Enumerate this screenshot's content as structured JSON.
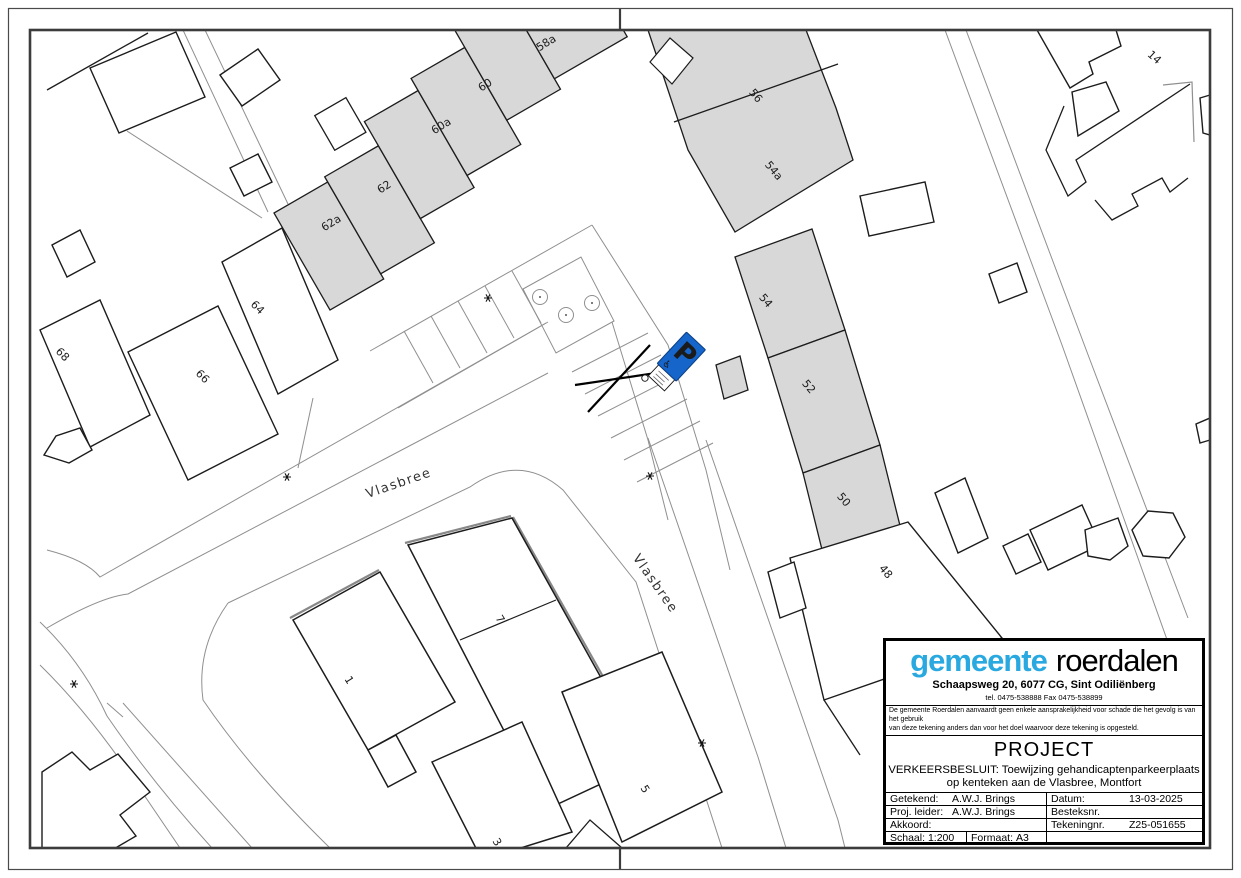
{
  "title_block": {
    "logo": {
      "word1": "gemeente",
      "word2": "roerdalen",
      "brand_color": "#29a9e0"
    },
    "address": "Schaapsweg 20, 6077 CG, Sint Odiliënberg",
    "phone": "tel. 0475-538888  Fax 0475-538899",
    "disclaimer_line1": "De gemeente Roerdalen aanvaardt geen enkele aansprakelijkheid voor schade die het gevolg is van het gebruik",
    "disclaimer_line2": "van deze tekening anders dan voor het doel waarvoor deze tekening is opgesteld.",
    "project_heading": "PROJECT",
    "project_line1": "VERKEERSBESLUIT: Toewijzing gehandicaptenparkeerplaats",
    "project_line2": "op kenteken aan de Vlasbree, Montfort",
    "fields": {
      "getekend_label": "Getekend:",
      "getekend_value": "A.W.J. Brings",
      "proj_leider_label": "Proj. leider:",
      "proj_leider_value": "A.W.J. Brings",
      "akkoord_label": "Akkoord:",
      "akkoord_value": "",
      "datum_label": "Datum:",
      "datum_value": "13-03-2025",
      "besteksnr_label": "Besteksnr.",
      "besteksnr_value": "",
      "tekeningnr_label": "Tekeningnr.",
      "tekeningnr_value": "Z25-051655",
      "schaal_label": "Schaal:",
      "schaal_value": "1:200",
      "formaat_label": "Formaat:",
      "formaat_value": "A3"
    }
  },
  "map": {
    "street_labels": [
      {
        "text": "Vlasbree"
      },
      {
        "text": "Vlasbree"
      }
    ],
    "house_numbers": [
      {
        "text": "58a"
      },
      {
        "text": "60"
      },
      {
        "text": "60a"
      },
      {
        "text": "62"
      },
      {
        "text": "62a"
      },
      {
        "text": "56"
      },
      {
        "text": "54a"
      },
      {
        "text": "54"
      },
      {
        "text": "52"
      },
      {
        "text": "50"
      },
      {
        "text": "48"
      },
      {
        "text": "64"
      },
      {
        "text": "66"
      },
      {
        "text": "68"
      },
      {
        "text": "14"
      },
      {
        "text": "7"
      },
      {
        "text": "1"
      },
      {
        "text": "5"
      },
      {
        "text": "3"
      }
    ],
    "parking_sign": {
      "letter": "P",
      "sign_color": "#1565cb",
      "icons": [
        "wheelchair-icon",
        "license-plate"
      ]
    },
    "symbols": {
      "tree_or_lamp": "asterisk-icon",
      "tree_circles": 3
    }
  },
  "colors": {
    "building_fill": "#d8d8d8",
    "building_stroke": "#1c1c1c",
    "thin_line": "#8f8f8f",
    "sign_blue": "#1565cb",
    "logo_blue": "#29a9e0"
  }
}
